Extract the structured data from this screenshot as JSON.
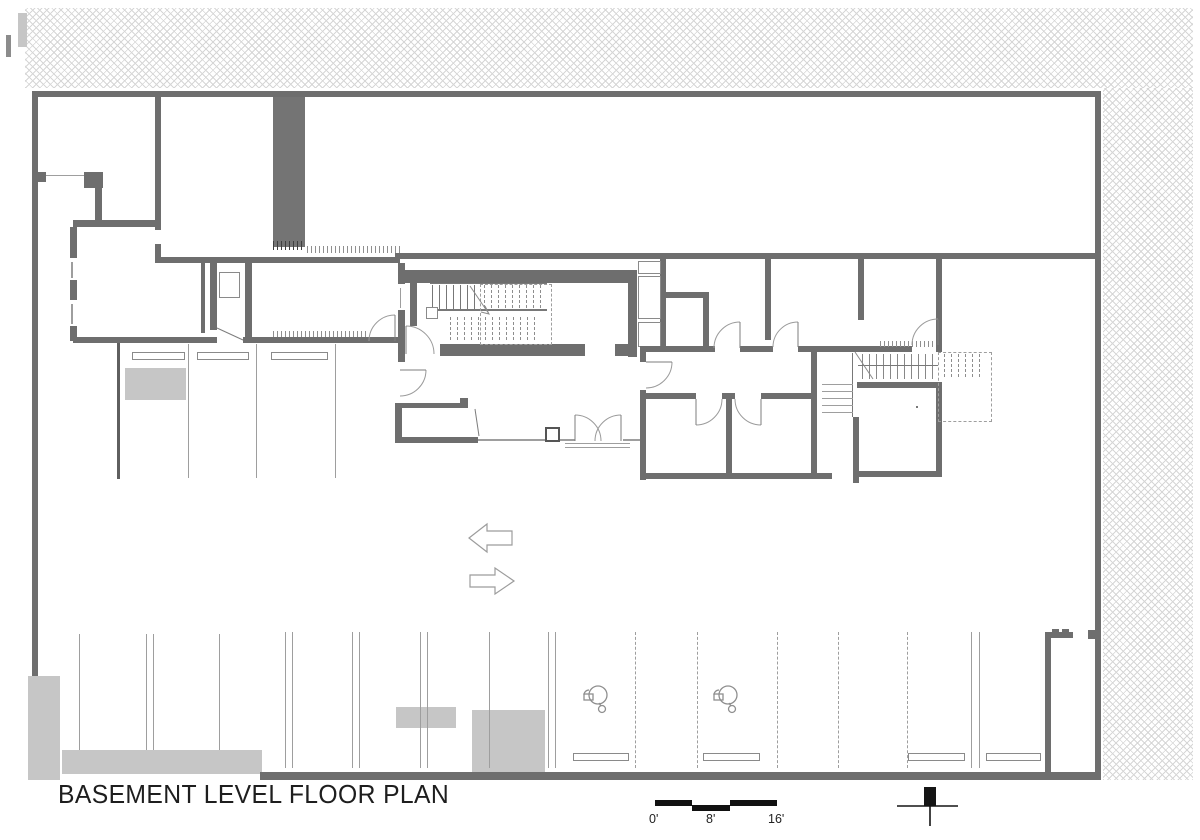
{
  "drawing": {
    "title": "BASEMENT LEVEL FLOOR PLAN",
    "type": "architectural floor plan"
  },
  "scale_bar": {
    "labels": [
      "0'",
      "8'",
      "16'"
    ],
    "bar_color": "#111111"
  },
  "annotations": {
    "direction_arrows": [
      "left",
      "right"
    ],
    "north_marker": "cross-marker",
    "motorcycle_parking_symbols": 2
  },
  "legend_colors": {
    "wall": "#6e6e6e",
    "shaft_fill": "#747474",
    "concrete_fill": "#c6c6c6",
    "hatch_line": "#cdcdcd",
    "thin_line": "#9e9e9e",
    "black": "#111111"
  },
  "features": [
    "hatched site boundary along top and right",
    "central stair core with dashed upper flight",
    "second stair with dashed elevator outline",
    "upper parking row with wheel stops",
    "lower parking row with dashed stalls and wheel stops",
    "double entry doors",
    "drive aisle with two-way traffic arrows"
  ]
}
